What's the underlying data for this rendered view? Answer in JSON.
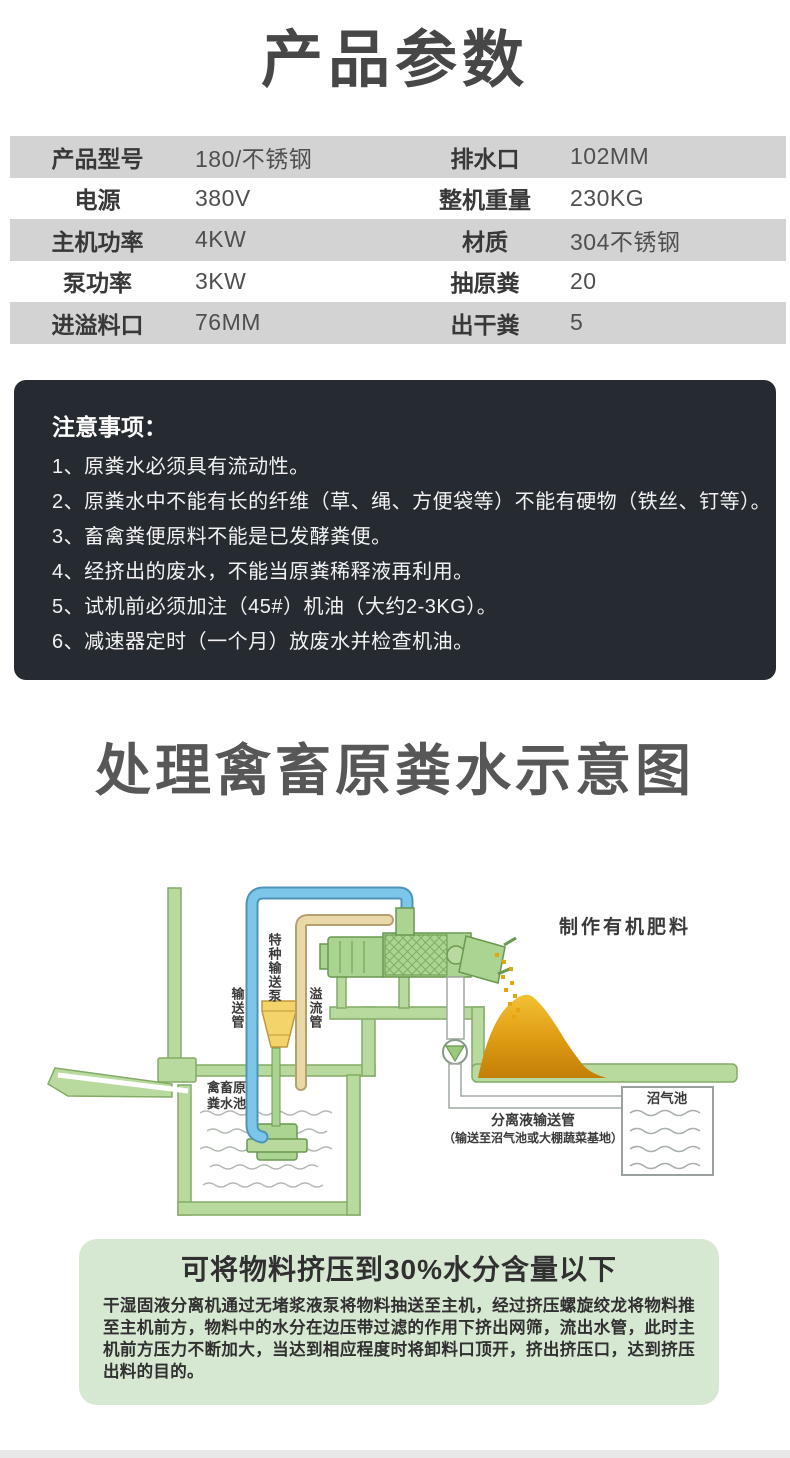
{
  "page": {
    "title": "产品参数",
    "diagram_title": "处理禽畜原粪水示意图"
  },
  "specs": {
    "rows": [
      {
        "label1": "产品型号",
        "value1": "180/不锈钢",
        "label2": "排水口",
        "value2": "102MM"
      },
      {
        "label1": "电源",
        "value1": "380V",
        "label2": "整机重量",
        "value2": "230KG"
      },
      {
        "label1": "主机功率",
        "value1": "4KW",
        "label2": "材质",
        "value2": "304不锈钢"
      },
      {
        "label1": "泵功率",
        "value1": "3KW",
        "label2": "抽原粪",
        "value2": "20"
      },
      {
        "label1": "进溢料口",
        "value1": "76MM",
        "label2": "出干粪",
        "value2": "5"
      }
    ]
  },
  "notes": {
    "title": "注意事项：",
    "items": [
      "1、原粪水必须具有流动性。",
      "2、原粪水中不能有长的纤维（草、绳、方便袋等）不能有硬物（铁丝、钉等）。",
      "3、畜禽粪便原料不能是已发酵粪便。",
      "4、经挤出的废水，不能当原粪稀释液再利用。",
      "5、试机前必须加注（45#）机油（大约2-3KG）。",
      "6、减速器定时（一个月）放废水并检查机油。"
    ]
  },
  "diagram": {
    "labels": {
      "fertilizer": "制作有机肥料",
      "convey_pipe": "输送管",
      "special_pump": "特种输送泵",
      "overflow_pipe": "溢流管",
      "manure_pool_line1": "禽畜原",
      "manure_pool_line2": "粪水池",
      "separated_pipe": "分离液输送管",
      "separated_pipe_note": "（输送至沼气池或大棚蔬菜基地）",
      "biogas_pool": "沼气池"
    }
  },
  "summary": {
    "title": "可将物料挤压到30%水分含量以下",
    "body": "干湿固液分离机通过无堵浆液泵将物料抽送至主机，经过挤压螺旋绞龙将物料推至主机前方，物料中的水分在边压带过滤的作用下挤出网筛，流出水管，此时主机前方压力不断加大，当达到相应程度时将卸料口顶开，挤出挤压口，达到挤压出料的目的。"
  },
  "colors": {
    "table_row_gray": "#d3d3d3",
    "notes_bg": "#262b32",
    "summary_bg": "#d7e8d2",
    "bottom_strip": "#e8e8e8",
    "pipe_blue": "#7cc7e9",
    "pipe_tan": "#ead9a8",
    "machine_green": "#abd392",
    "ground_green": "#b9da9e",
    "pump_yellow": "#f3d46b",
    "pile_gold": "#dd9a12",
    "text_dark": "#474747"
  }
}
